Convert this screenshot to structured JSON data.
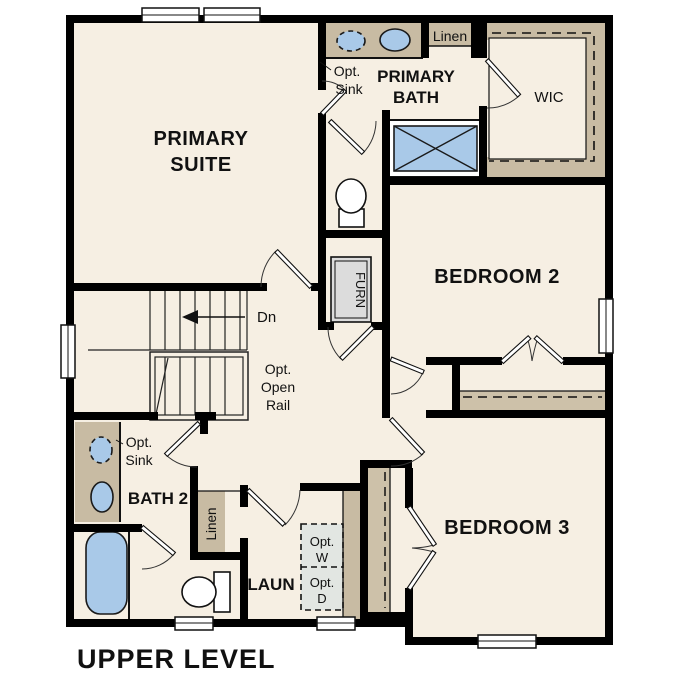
{
  "title": "UPPER LEVEL",
  "colors": {
    "wall": "#000000",
    "floor": "#f6efe3",
    "counter": "#c8bba3",
    "shelf": "#cdc1a9",
    "fixture_blue": "#a9c9e8",
    "appliance_gray": "#e2e6e2",
    "furnace_gray": "#dcdcdc",
    "window_white": "#ffffff"
  },
  "rooms": {
    "primary_suite": {
      "line1": "PRIMARY",
      "line2": "SUITE"
    },
    "primary_bath": {
      "line1": "PRIMARY",
      "line2": "BATH"
    },
    "wic": {
      "label": "WIC"
    },
    "bedroom2": {
      "label": "BEDROOM 2"
    },
    "bedroom3": {
      "label": "BEDROOM 3"
    },
    "bath2": {
      "label": "BATH 2"
    },
    "laundry": {
      "label": "LAUN"
    }
  },
  "annotations": {
    "linen_bath_hall": "Linen",
    "linen_bath2": "Linen",
    "furnace": "FURN",
    "stairs_down": "Dn",
    "open_rail": {
      "line1": "Opt.",
      "line2": "Open",
      "line3": "Rail"
    },
    "opt_sink_primary": {
      "line1": "Opt.",
      "line2": "Sink"
    },
    "opt_sink_bath2": {
      "line1": "Opt.",
      "line2": "Sink"
    },
    "opt_washer": {
      "line1": "Opt.",
      "line2": "W"
    },
    "opt_dryer": {
      "line1": "Opt.",
      "line2": "D"
    }
  }
}
